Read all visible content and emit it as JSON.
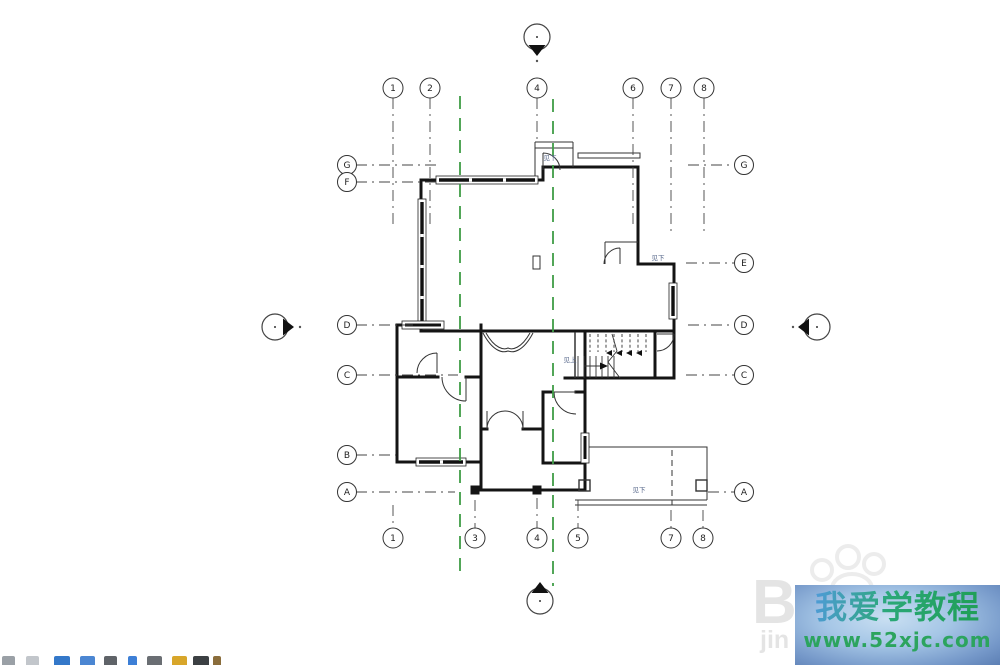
{
  "app": {
    "canvas_bg": "#ffffff"
  },
  "watermark": {
    "title": "我爱学教程",
    "url": "www.52xjc.com",
    "colors": {
      "box_center": "#c9dff2",
      "box_edge": "#5c7fb4",
      "title_blue": "#4f9bd8",
      "title_green": "#1f9e55",
      "url": "#2ca45e"
    },
    "ghost": {
      "letter": "B",
      "text": "jin"
    }
  },
  "plan": {
    "colors": {
      "line": "#444444",
      "wall": "#141414",
      "matchline": "#3f9d46",
      "annotation": "#56678a"
    },
    "grids": {
      "top": [
        {
          "label": "1",
          "x": 393,
          "len": 225
        },
        {
          "label": "2",
          "x": 430,
          "len": 225
        },
        {
          "label": "4",
          "x": 537,
          "len": 140
        },
        {
          "label": "6",
          "x": 633,
          "len": 228
        },
        {
          "label": "7",
          "x": 671,
          "len": 232
        },
        {
          "label": "8",
          "x": 704,
          "len": 232
        }
      ],
      "bottom": [
        {
          "label": "1",
          "x": 393,
          "len": 505
        },
        {
          "label": "3",
          "x": 475,
          "len": 500
        },
        {
          "label": "4",
          "x": 537,
          "len": 498
        },
        {
          "label": "5",
          "x": 578,
          "len": 500
        },
        {
          "label": "7",
          "x": 671,
          "len": 510
        },
        {
          "label": "8",
          "x": 703,
          "len": 510
        }
      ],
      "left": [
        {
          "label": "G",
          "y": 165,
          "len": 438
        },
        {
          "label": "F",
          "y": 182,
          "len": 438
        },
        {
          "label": "D",
          "y": 325,
          "len": 418
        },
        {
          "label": "C",
          "y": 375,
          "len": 458
        },
        {
          "label": "B",
          "y": 455,
          "len": 396
        },
        {
          "label": "A",
          "y": 492,
          "len": 455
        }
      ],
      "right": [
        {
          "label": "G",
          "y": 165,
          "len": 688
        },
        {
          "label": "E",
          "y": 263,
          "len": 686
        },
        {
          "label": "D",
          "y": 325,
          "len": 688
        },
        {
          "label": "C",
          "y": 375,
          "len": 686
        },
        {
          "label": "A",
          "y": 492,
          "len": 708
        }
      ]
    },
    "matchlines": [
      {
        "x": 460,
        "y1": 96,
        "y2": 575
      },
      {
        "x": 553,
        "y1": 99,
        "y2": 586
      }
    ],
    "elevation_markers": [
      {
        "x": 537,
        "y": 37,
        "dir": "down"
      },
      {
        "x": 540,
        "y": 601,
        "dir": "up"
      },
      {
        "x": 275,
        "y": 327,
        "dir": "right"
      },
      {
        "x": 817,
        "y": 327,
        "dir": "left"
      }
    ],
    "marker_dots": [
      {
        "x": 537,
        "y": 61
      },
      {
        "x": 300,
        "y": 327
      },
      {
        "x": 793,
        "y": 327
      }
    ],
    "annotations": [
      {
        "text": "见下",
        "x": 550,
        "y": 160
      },
      {
        "text": "见下",
        "x": 658,
        "y": 260
      },
      {
        "text": "见上",
        "x": 570,
        "y": 362
      },
      {
        "text": "见下",
        "x": 639,
        "y": 492
      }
    ]
  },
  "toolbar": {
    "icons": [
      {
        "name": "pan",
        "color": "#9aa0a6",
        "x": 2,
        "w": 13
      },
      {
        "name": "zoom",
        "color": "#c2c6cb",
        "x": 26,
        "w": 13
      },
      {
        "name": "scale",
        "color": "#3478c9",
        "x": 54,
        "w": 16
      },
      {
        "name": "detail-level",
        "color": "#4b86d2",
        "x": 80,
        "w": 15
      },
      {
        "name": "visual-style",
        "color": "#5f6368",
        "x": 104,
        "w": 13
      },
      {
        "name": "sun-path",
        "color": "#3d7fd6",
        "x": 128,
        "w": 9
      },
      {
        "name": "shadows",
        "color": "#6a6e73",
        "x": 147,
        "w": 15
      },
      {
        "name": "crop-view",
        "color": "#d8a62a",
        "x": 172,
        "w": 15
      },
      {
        "name": "crop-region",
        "color": "#3c4043",
        "x": 193,
        "w": 16
      },
      {
        "name": "pencil",
        "color": "#8a6d3b",
        "x": 213,
        "w": 8
      }
    ]
  }
}
